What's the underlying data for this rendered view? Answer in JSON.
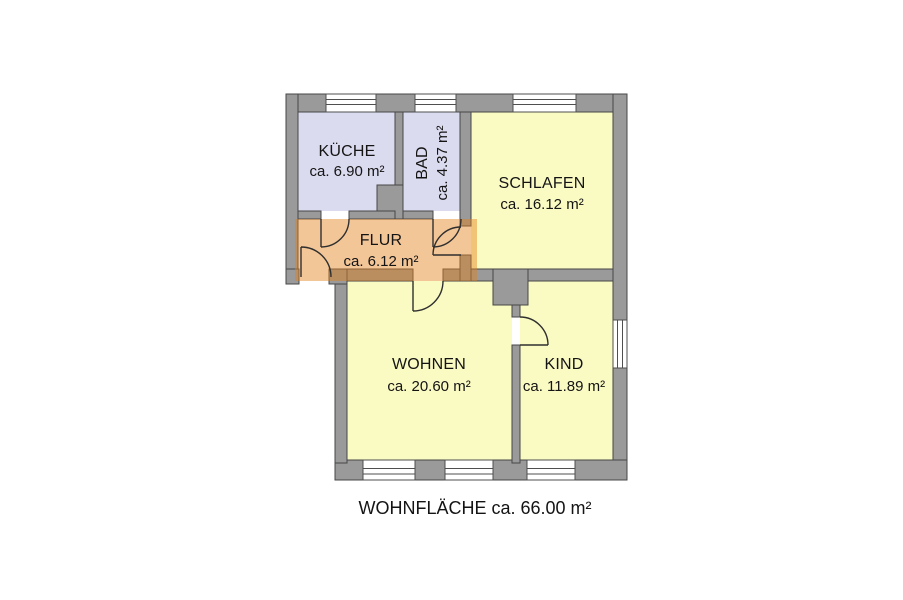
{
  "plan": {
    "type": "apartment-floor-plan",
    "rooms": [
      {
        "id": "kueche",
        "name": "KÜCHE",
        "area": "ca. 6.90 m²",
        "color": "#dbdbf0"
      },
      {
        "id": "bad",
        "name": "BAD",
        "area": "ca. 4.37 m²",
        "color": "#dbdbf0"
      },
      {
        "id": "schlafen",
        "name": "SCHLAFEN",
        "area": "ca. 16.12 m²",
        "color": "#fafac3"
      },
      {
        "id": "flur",
        "name": "FLUR",
        "area": "ca. 6.12 m²",
        "color": "rgba(229,128,27,0.45)"
      },
      {
        "id": "wohnen",
        "name": "WOHNEN",
        "area": "ca. 20.60 m²",
        "color": "#fafac3"
      },
      {
        "id": "kind",
        "name": "KIND",
        "area": "ca. 11.89 m²",
        "color": "#fafac3"
      }
    ],
    "footer": {
      "text": "WOHNFLÄCHE ca. 66.00 m²"
    },
    "colors": {
      "wall": "#9a9a9a",
      "wall_outline": "#474747",
      "room_purple": "#dbdbf0",
      "room_yellow": "#fafac3",
      "flur_overlay": "rgba(229,128,27,0.45)",
      "window": "#ffffff",
      "text": "#141414"
    }
  }
}
